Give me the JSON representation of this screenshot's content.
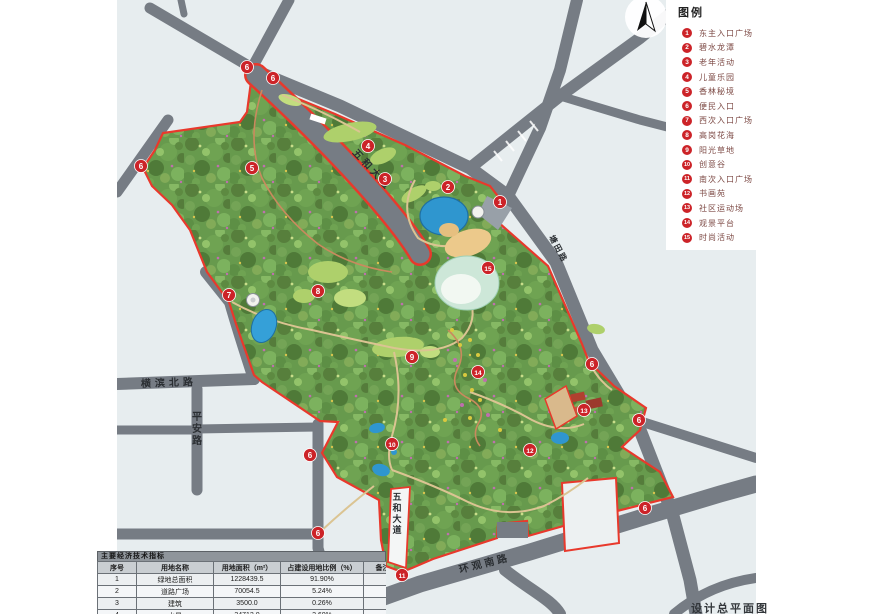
{
  "doc": {
    "plan_title": "设计总平面图"
  },
  "legend": {
    "title": "图例",
    "items": [
      {
        "num": "1",
        "label": "东主入口广场"
      },
      {
        "num": "2",
        "label": "碧水龙潭"
      },
      {
        "num": "3",
        "label": "老年活动"
      },
      {
        "num": "4",
        "label": "儿童乐园"
      },
      {
        "num": "5",
        "label": "香林秘境"
      },
      {
        "num": "6",
        "label": "便民入口"
      },
      {
        "num": "7",
        "label": "西次入口广场"
      },
      {
        "num": "8",
        "label": "高岗花海"
      },
      {
        "num": "9",
        "label": "阳光草地"
      },
      {
        "num": "10",
        "label": "创意谷"
      },
      {
        "num": "11",
        "label": "南次入口广场"
      },
      {
        "num": "12",
        "label": "书画苑"
      },
      {
        "num": "13",
        "label": "社区运动场"
      },
      {
        "num": "14",
        "label": "观景平台"
      },
      {
        "num": "15",
        "label": "时尚活动"
      }
    ]
  },
  "road_labels": [
    "横滨北路",
    "平安路",
    "五和大道",
    "五和大道",
    "环观南路",
    "塘田路"
  ],
  "map": {
    "marker_nums": [
      "1",
      "2",
      "3",
      "4",
      "5",
      "7",
      "8",
      "9",
      "10",
      "11",
      "12",
      "13",
      "14",
      "15",
      "6",
      "6",
      "6",
      "6",
      "6",
      "6",
      "6",
      "6"
    ]
  },
  "table": {
    "title": "主要经济技术指标",
    "headers": [
      "序号",
      "用地名称",
      "用地面积（m²）",
      "占建设用地比例（%）",
      "备注"
    ],
    "rows": [
      [
        "1",
        "绿地总面积",
        "1228439.5",
        "91.90%",
        ""
      ],
      [
        "2",
        "道路广场",
        "70054.5",
        "5.24%",
        ""
      ],
      [
        "3",
        "建筑",
        "3500.0",
        "0.26%",
        ""
      ],
      [
        "4",
        "水景",
        "34712.0",
        "2.60%",
        ""
      ],
      [
        "",
        "合计",
        "1336706",
        "100",
        ""
      ]
    ]
  },
  "colors": {
    "boundary_red": "#e8392c",
    "marker_red": "#cc2328",
    "road_gray": "#767c84",
    "water_blue": "#2f96cf",
    "park_green": "#679a4d",
    "map_bg": "#e7edef"
  }
}
